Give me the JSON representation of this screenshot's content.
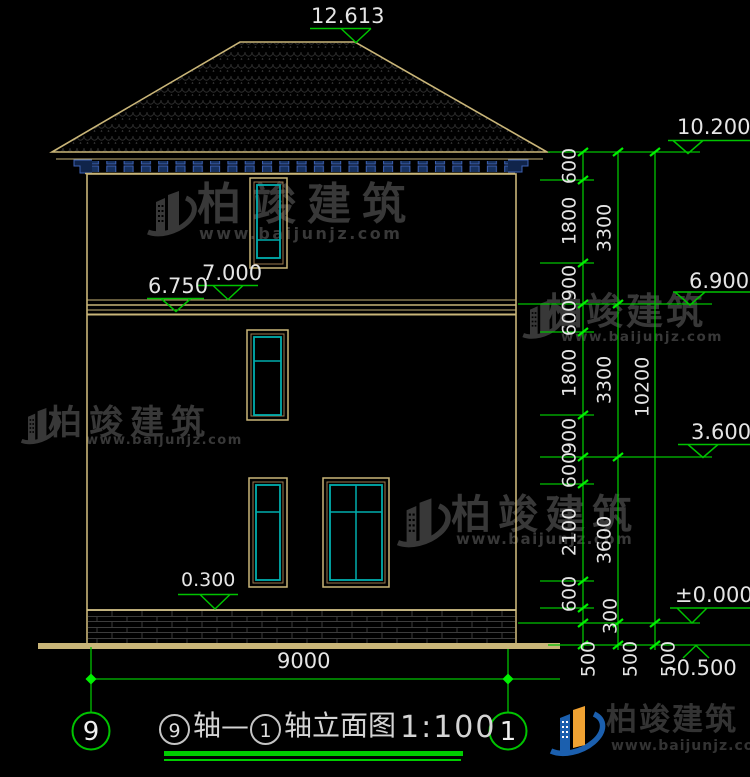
{
  "watermark": {
    "brand": "柏竣建筑",
    "site": "www.baijunjz.com"
  },
  "footer": {
    "brand": "柏竣建筑",
    "site": "www.baijunjz.com"
  },
  "title": {
    "circle_left": "9",
    "mid": "轴—",
    "circle_right": "1",
    "suffix": "轴立面图",
    "scale": "1:100"
  },
  "axes": {
    "left": "9",
    "right": "1"
  },
  "levels": {
    "ridge": "12.613",
    "eave": "10.200",
    "right_mid": "6.900",
    "band_top": "7.000",
    "band_bottom": "6.750",
    "floor2": "3.600",
    "plinth": "0.300",
    "zero": "±0.000",
    "ground": "-0.500"
  },
  "dims": {
    "overall_width": "9000",
    "chain_inner": [
      "600",
      "1800",
      "900",
      "600",
      "1800",
      "900",
      "600",
      "2100",
      "600",
      "300",
      "500"
    ],
    "chain_mid": [
      "3300",
      "3300",
      "3600",
      "500"
    ],
    "chain_outer": [
      "10200",
      "500"
    ]
  },
  "colors": {
    "line_tan": "#C9B578",
    "dim_green": "#00C300",
    "window_cyan": "#00ADAD",
    "logo_blue": "#1B5FAE",
    "logo_orange": "#F0A232"
  }
}
